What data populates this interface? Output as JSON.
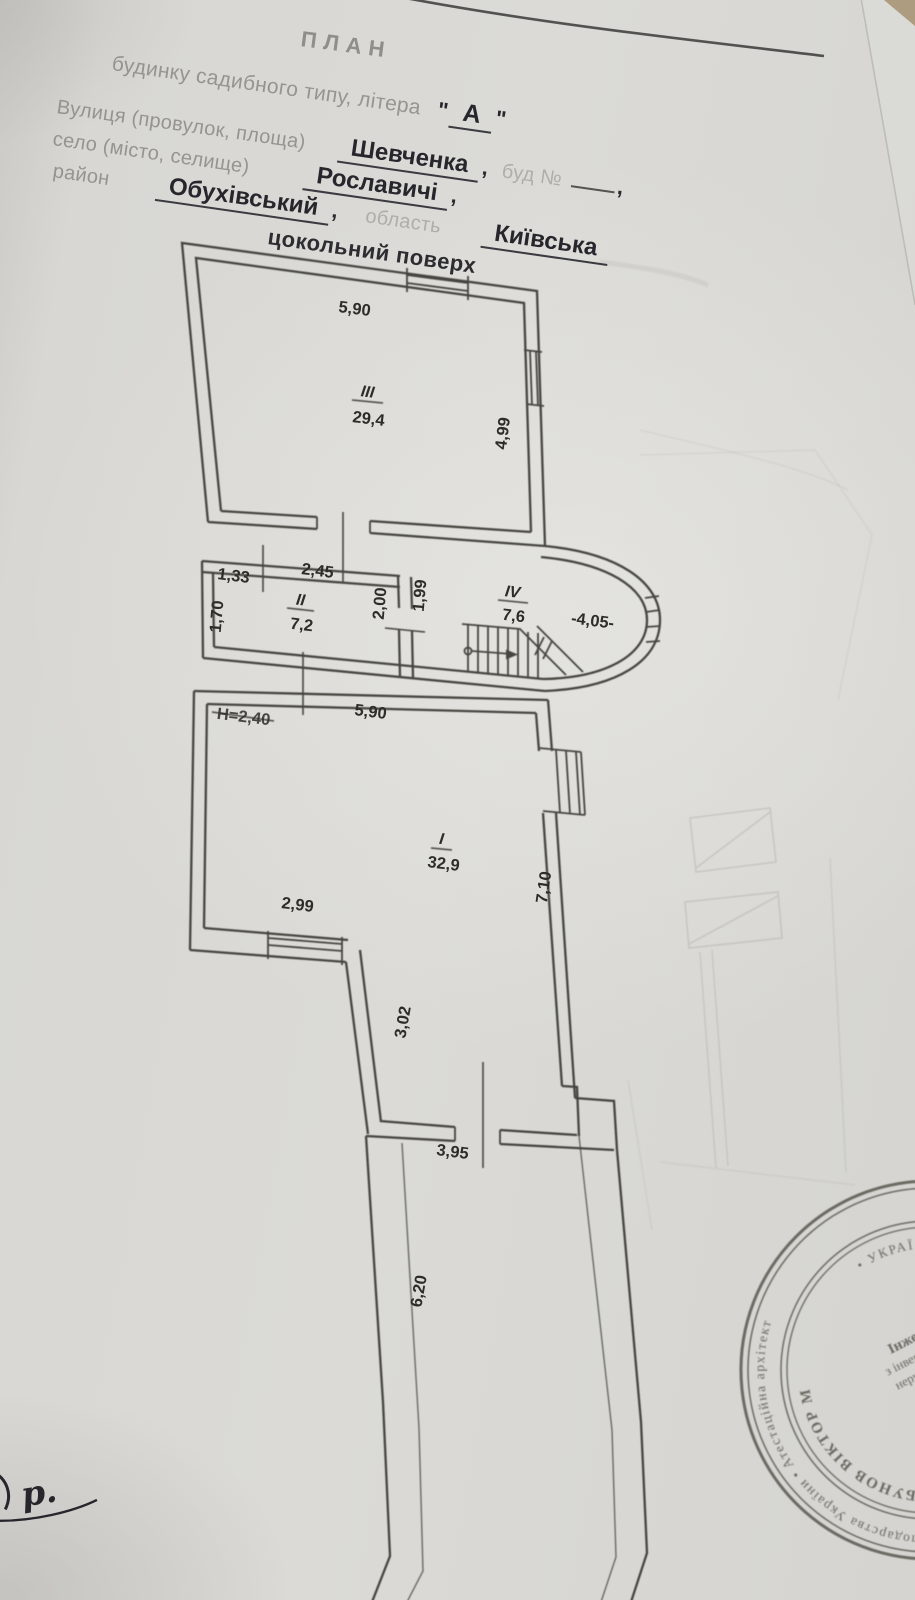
{
  "document": {
    "title": "ПЛАН",
    "subtitle_label": "будинку садибного типу, літера",
    "quote": "\"",
    "letter": "А",
    "street_label": "Вулиця (провулок, площа)",
    "street_value": "Шевченка",
    "comma": ",",
    "building_no_label": "буд №",
    "settlement_label": "село (місто, селище)",
    "settlement_value": "Рославичі",
    "district_label": "район",
    "district_value": "Обухівський",
    "region_label": "область",
    "region_value": "Київська",
    "floor_title": "цокольний поверх"
  },
  "plan": {
    "rooms": {
      "r3": {
        "num": "III",
        "area": "29,4"
      },
      "r2": {
        "num": "II",
        "area": "7,2"
      },
      "r4": {
        "num": "IV",
        "area": "7,6"
      },
      "r1": {
        "num": "I",
        "area": "32,9"
      }
    },
    "dims": {
      "room3_width": "5,90",
      "room3_depth": "4,99",
      "d133": "1,33",
      "d245": "2,45",
      "d170": "1,70",
      "d200": "2,00",
      "d199": "1,99",
      "level": "-4,05-",
      "height_note": "Н=2,40",
      "room1_width": "5,90",
      "room1_depth": "7,10",
      "d299": "2,99",
      "d302": "3,02",
      "d395": "3,95",
      "d620": "6,20"
    }
  },
  "stamp": {
    "ring_outer": "каційний серт • о-комунального господарства України • Атестаційна архітект",
    "ring_name": "ГОРБУНОВ ВІКТОР М",
    "ring_inner": "• УКРАЇ •",
    "center_line1": "Інженер",
    "center_line2": "з інвентаризац",
    "center_line3": "нерухомого м",
    "center_line4": "Реєстрац",
    "center_line5": "№ 1474"
  },
  "handwriting": {
    "note": "р."
  },
  "colors": {
    "paper": "#d8d7d3",
    "ink": "#3b3a36",
    "form_text": "#83827d",
    "value_text": "#26262c",
    "stamp": "#4f4f47"
  }
}
